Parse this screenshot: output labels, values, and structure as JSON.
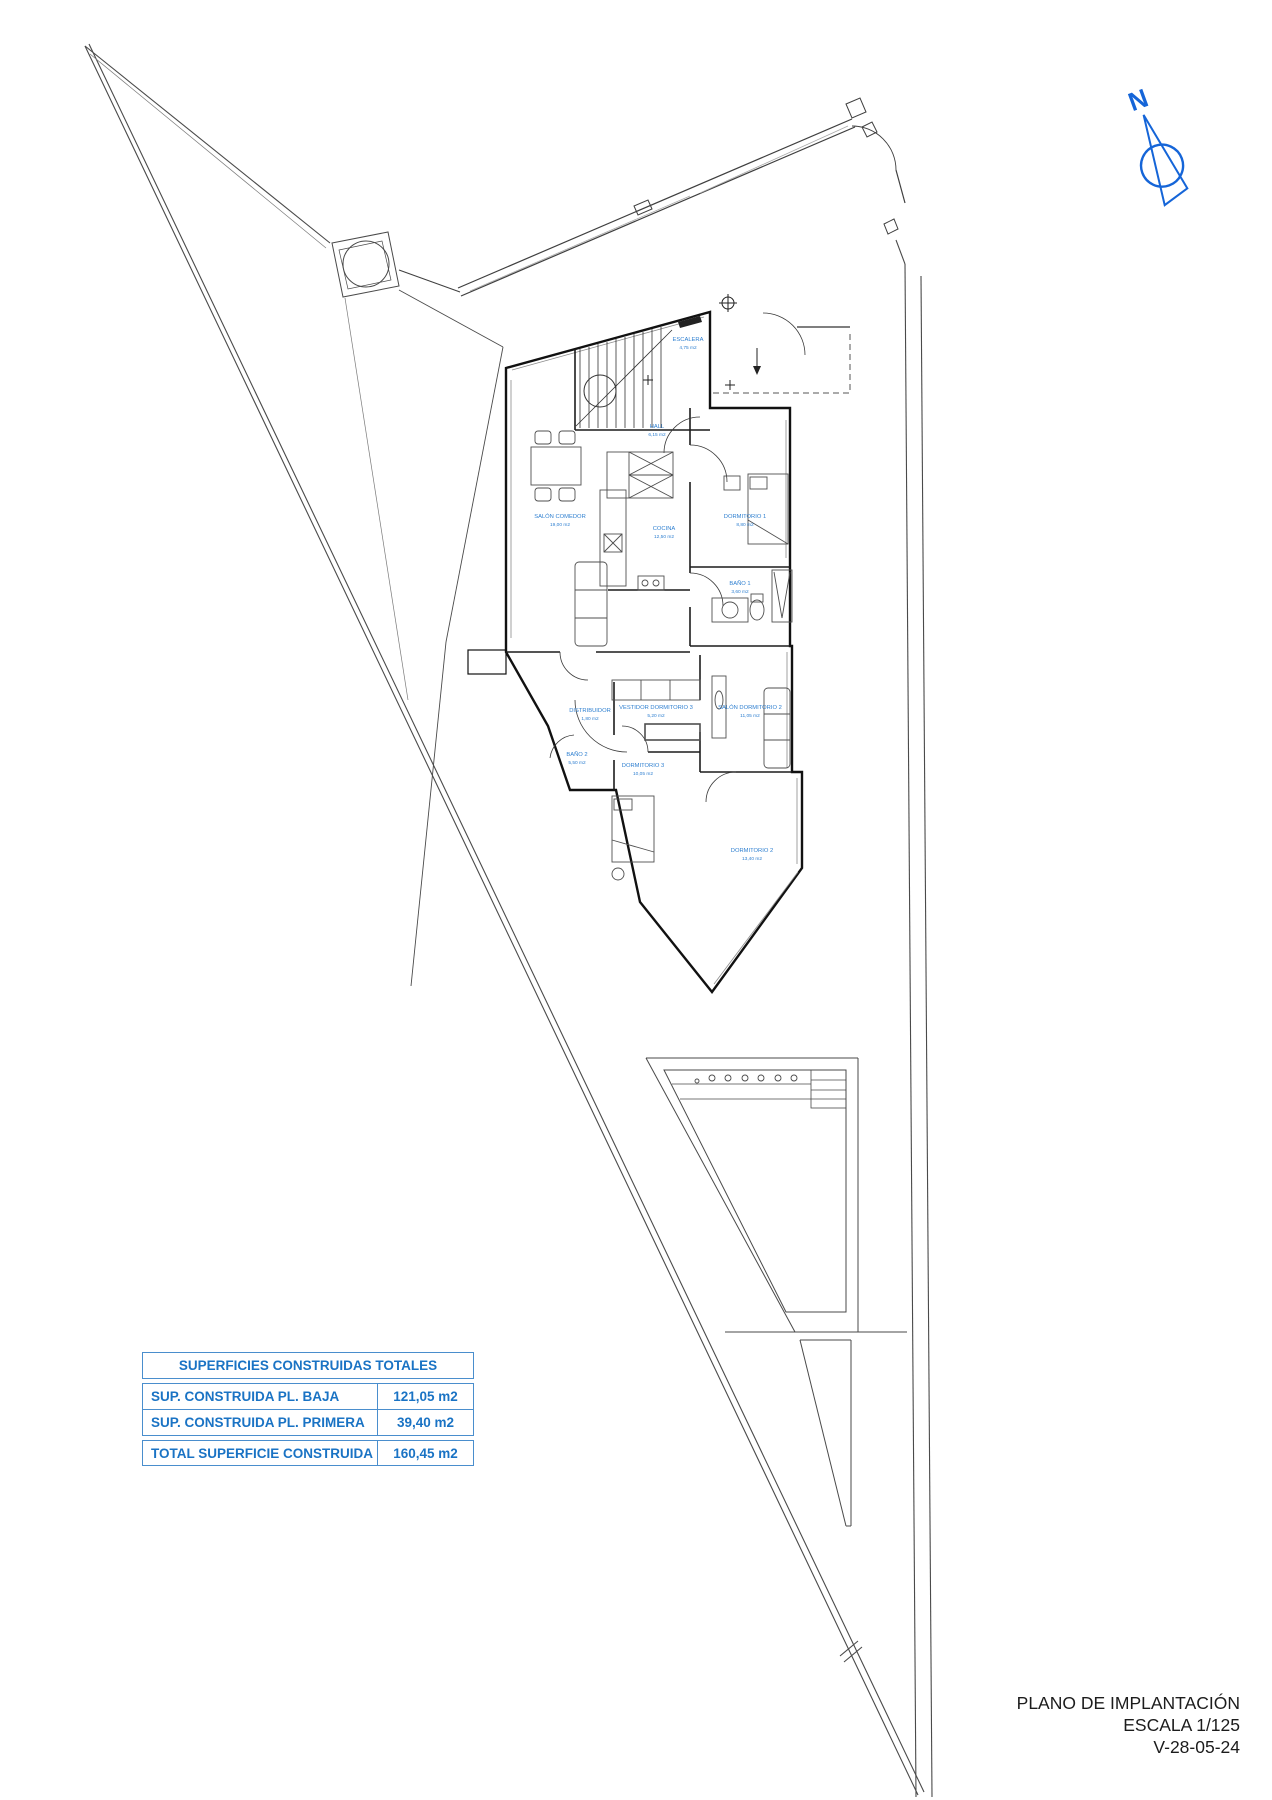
{
  "north": {
    "label": "N",
    "color": "#1565d8"
  },
  "rooms": [
    {
      "name": "ESCALERA",
      "area": "4,75 m2"
    },
    {
      "name": "HALL",
      "area": "6,15 m2"
    },
    {
      "name": "SALÓN COMEDOR",
      "area": "19,00 m2"
    },
    {
      "name": "COCINA",
      "area": "12,50 m2"
    },
    {
      "name": "DORMITORIO 1",
      "area": "8,80 m2"
    },
    {
      "name": "BAÑO 1",
      "area": "3,60 m2"
    },
    {
      "name": "DISTRIBUIDOR",
      "area": "1,80 m2"
    },
    {
      "name": "VESTIDOR DORMITORIO 3",
      "area": "5,20 m2"
    },
    {
      "name": "SALÓN DORMITORIO 2",
      "area": "11,05 m2"
    },
    {
      "name": "BAÑO 2",
      "area": "5,50 m2"
    },
    {
      "name": "DORMITORIO 3",
      "area": "10,05 m2"
    },
    {
      "name": "DORMITORIO 2",
      "area": "13,40 m2"
    }
  ],
  "areas_table": {
    "title": "SUPERFICIES CONSTRUIDAS TOTALES",
    "rows": [
      {
        "label": "SUP. CONSTRUIDA PL. BAJA",
        "value": "121,05 m2"
      },
      {
        "label": "SUP. CONSTRUIDA PL. PRIMERA",
        "value": "39,40 m2"
      }
    ],
    "total": {
      "label": "TOTAL SUPERFICIE CONSTRUIDA",
      "value": "160,45 m2"
    }
  },
  "title_block": {
    "title": "PLANO DE IMPLANTACIÓN",
    "scale": "ESCALA 1/125",
    "date_ref": "V-28-05-24"
  },
  "colors": {
    "accent_blue": "#1a73c4",
    "label_blue": "#2e7fd0",
    "line_black": "#1a1a1a"
  }
}
